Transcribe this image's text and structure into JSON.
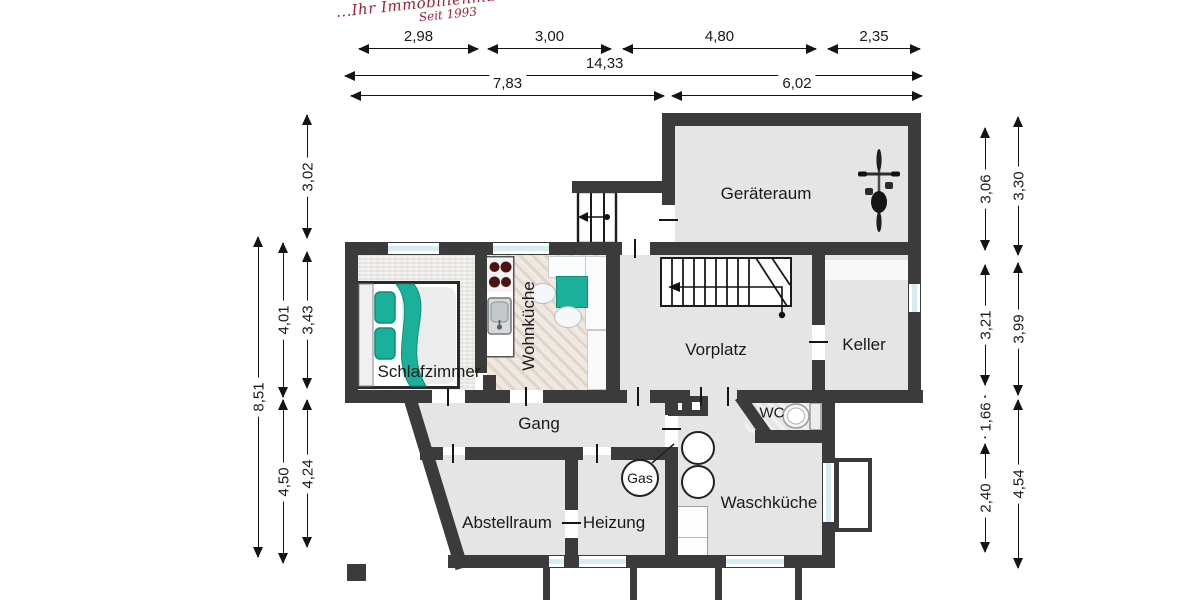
{
  "logo": {
    "line1": "...Ihr Immobilienmakler",
    "line2": "Seit 1993"
  },
  "dims": {
    "top_row": [
      "2,98",
      "3,00",
      "4,80",
      "2,35"
    ],
    "total": "14,33",
    "mid_row": [
      "7,83",
      "6,02"
    ],
    "left": [
      "3,02",
      "3,43",
      "4,24",
      "4,01",
      "4,50",
      "8,51"
    ],
    "right": [
      "3,06",
      "3,21",
      "1,66",
      "2,40",
      "3,30",
      "3,99",
      "4,54"
    ]
  },
  "rooms": {
    "geraeteraum": "Geräteraum",
    "schlafzimmer": "Schlafzimmer",
    "wohnkueche": "Wohnküche",
    "vorplatz": "Vorplatz",
    "keller": "Keller",
    "gang": "Gang",
    "wc": "WC",
    "waschkueche": "Waschküche",
    "heizung": "Heizung",
    "abstellraum": "Abstellraum",
    "gas": "Gas"
  },
  "colors": {
    "wall": "#3b3b3b",
    "window_glass": "#d8edf2",
    "accent_teal": "#1bb09a",
    "burner_red": "#4a1511",
    "logo_red": "#9c2336"
  }
}
